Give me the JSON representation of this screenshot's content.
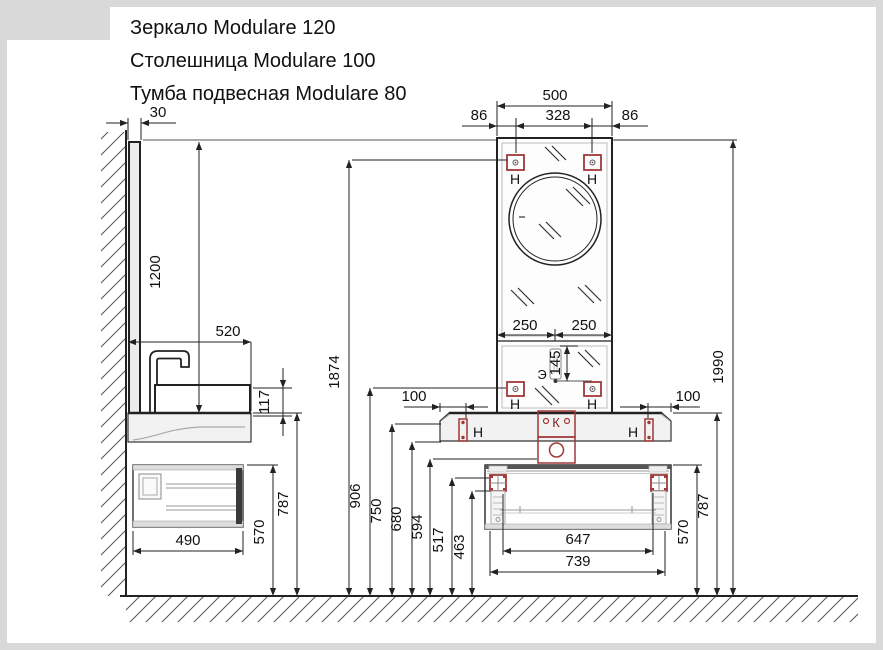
{
  "title": {
    "line1": "Зеркало Modulare 120",
    "line2": "Столешница Modulare 100",
    "line3": "Тумба подвесная Modulare 80"
  },
  "labels": {
    "mount": "Н",
    "siphon": "К",
    "outlet": "Э"
  },
  "dims": {
    "mirror_width": "500",
    "mount_offset_left": "86",
    "mount_spacing": "328",
    "mount_offset_right": "86",
    "mirror_half_left": "250",
    "mirror_half_right": "250",
    "outlet_offset": "145",
    "mirror_depth": "30",
    "mirror_height": "1200",
    "countertop_depth": "520",
    "basin_height": "117",
    "cabinet_depth": "490",
    "cabinet_top_left": "570",
    "countertop_left": "787",
    "mount_top": "1874",
    "mount_low": "906",
    "h750": "750",
    "h680": "680",
    "h594": "594",
    "h517": "517",
    "h463": "463",
    "bracket_left": "100",
    "bracket_right": "100",
    "cabinet_mount_inner": "647",
    "cabinet_mount_outer": "739",
    "cabinet_top_right": "570",
    "countertop_right": "787",
    "total_height": "1990"
  },
  "colors": {
    "line": "#222222",
    "accent_red": "#a03838",
    "fill_light": "#f2f2f2",
    "border_gray": "#d9d9d9"
  }
}
